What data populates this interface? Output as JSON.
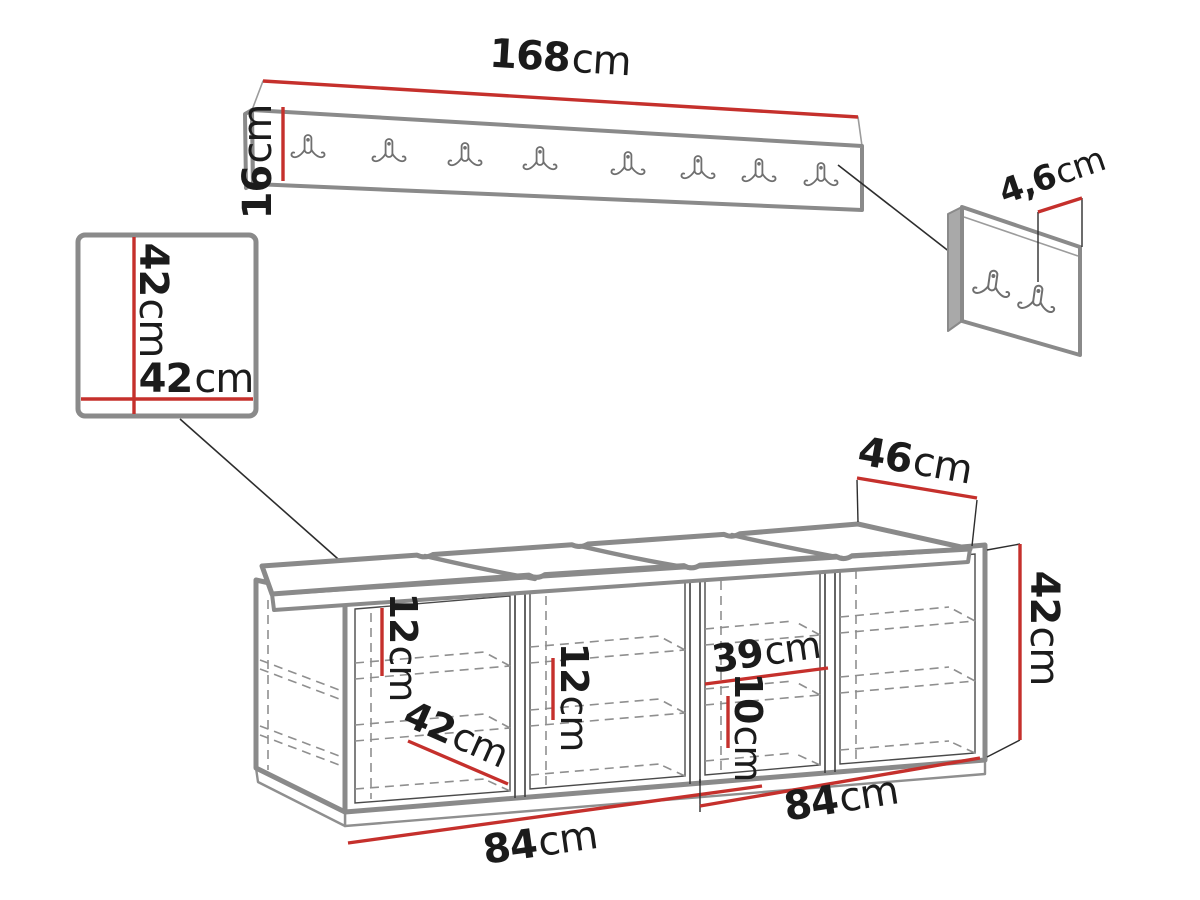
{
  "diagram_title": "Hallway furniture set dimension drawing",
  "colors": {
    "background": "#ffffff",
    "dimension_red": "#c5302c",
    "furniture_gray": "#8a8a8a",
    "text_black": "#1b1b1b"
  },
  "coat_rack": {
    "hook_count": 8,
    "length_label": {
      "value": "168",
      "unit": "cm"
    },
    "height_label": {
      "value": "16",
      "unit": "cm"
    }
  },
  "hook_panel": {
    "hook_count": 2,
    "depth_label": {
      "value": "4,6",
      "unit": "cm"
    }
  },
  "mirror_panel": {
    "height_label": {
      "value": "42",
      "unit": "cm"
    },
    "width_label": {
      "value": "42",
      "unit": "cm"
    }
  },
  "bench": {
    "compartment_count": 4,
    "seat_cushion_count": 4,
    "depth_label": {
      "value": "46",
      "unit": "cm"
    },
    "height_label": {
      "value": "42",
      "unit": "cm"
    },
    "shelf_gap_1_label": {
      "value": "12",
      "unit": "cm"
    },
    "shelf_gap_2_label": {
      "value": "12",
      "unit": "cm"
    },
    "niche_width_label": {
      "value": "39",
      "unit": "cm"
    },
    "shelf_gap_3_label": {
      "value": "10",
      "unit": "cm"
    },
    "inner_depth_label": {
      "value": "42",
      "unit": "cm"
    },
    "width_left_label": {
      "value": "84",
      "unit": "cm"
    },
    "width_right_label": {
      "value": "84",
      "unit": "cm"
    }
  }
}
